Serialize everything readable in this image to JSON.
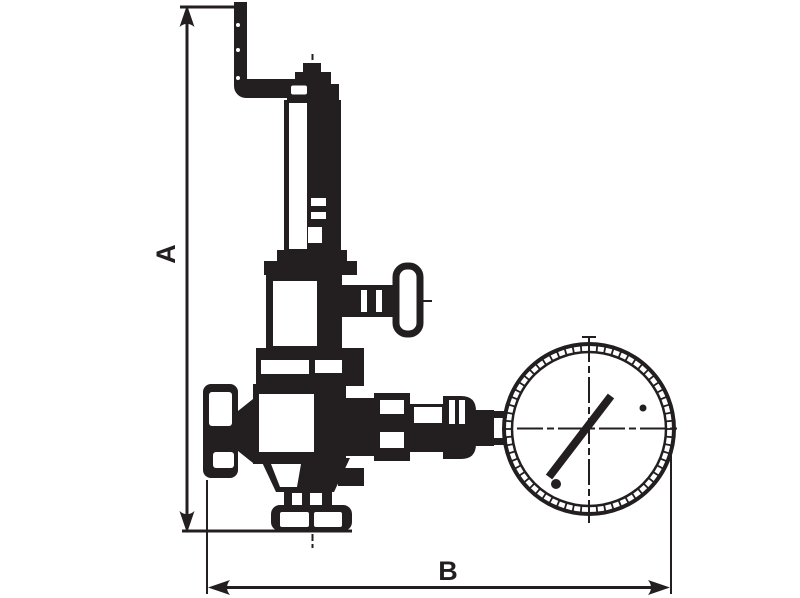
{
  "drawing": {
    "type": "technical-dimension-drawing",
    "subject": "safety relief valve with pressure gauge",
    "background": "#ffffff",
    "ink": "#231f20",
    "labels": {
      "dim_vertical": "A",
      "dim_horizontal": "B"
    },
    "dimensions": [
      {
        "label": "A",
        "orientation": "vertical",
        "measures": "overall height"
      },
      {
        "label": "B",
        "orientation": "horizontal",
        "measures": "overall width"
      }
    ],
    "parts": [
      {
        "name": "test-lever"
      },
      {
        "name": "spring-bonnet"
      },
      {
        "name": "adjusting-t-handle"
      },
      {
        "name": "valve-body"
      },
      {
        "name": "inlet-cap"
      },
      {
        "name": "outlet-union"
      },
      {
        "name": "gauge-stem"
      },
      {
        "name": "pressure-gauge"
      },
      {
        "name": "gauge-needle"
      },
      {
        "name": "bottom-connection"
      }
    ]
  }
}
